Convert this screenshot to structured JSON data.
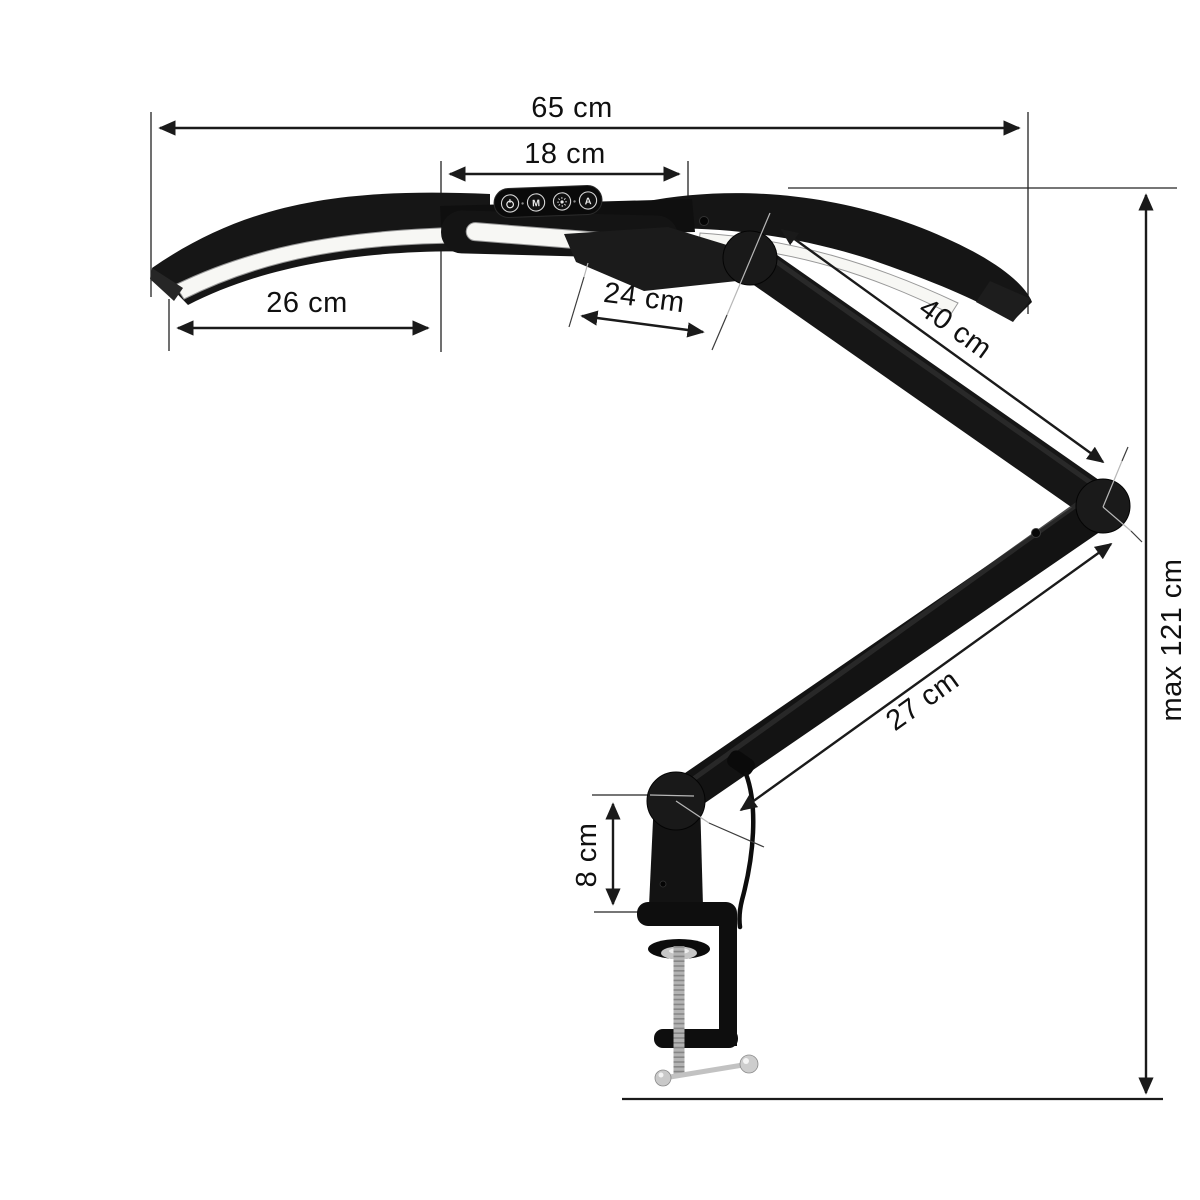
{
  "canvas": {
    "width": 1200,
    "height": 1200,
    "background": "#ffffff"
  },
  "dimension_labels": {
    "total_width": "65 cm",
    "head_width": "18 cm",
    "left_lamp_length": "26 cm",
    "head_depth": "24 cm",
    "upper_arm_length": "40 cm",
    "lower_arm_length": "27 cm",
    "clamp_height": "8 cm",
    "max_height": "max 121 cm"
  },
  "control_panel": {
    "power_icon": "power-symbol",
    "mode_button_label": "M",
    "brightness_icon": "sun-symbol",
    "auto_button_label": "A"
  },
  "colors": {
    "dimension_lines": "#1a1a1a",
    "label_text": "#101010",
    "lamp_body": "#161616",
    "led_strip": "#f7f7f4",
    "chrome": "#c6c6c6"
  }
}
